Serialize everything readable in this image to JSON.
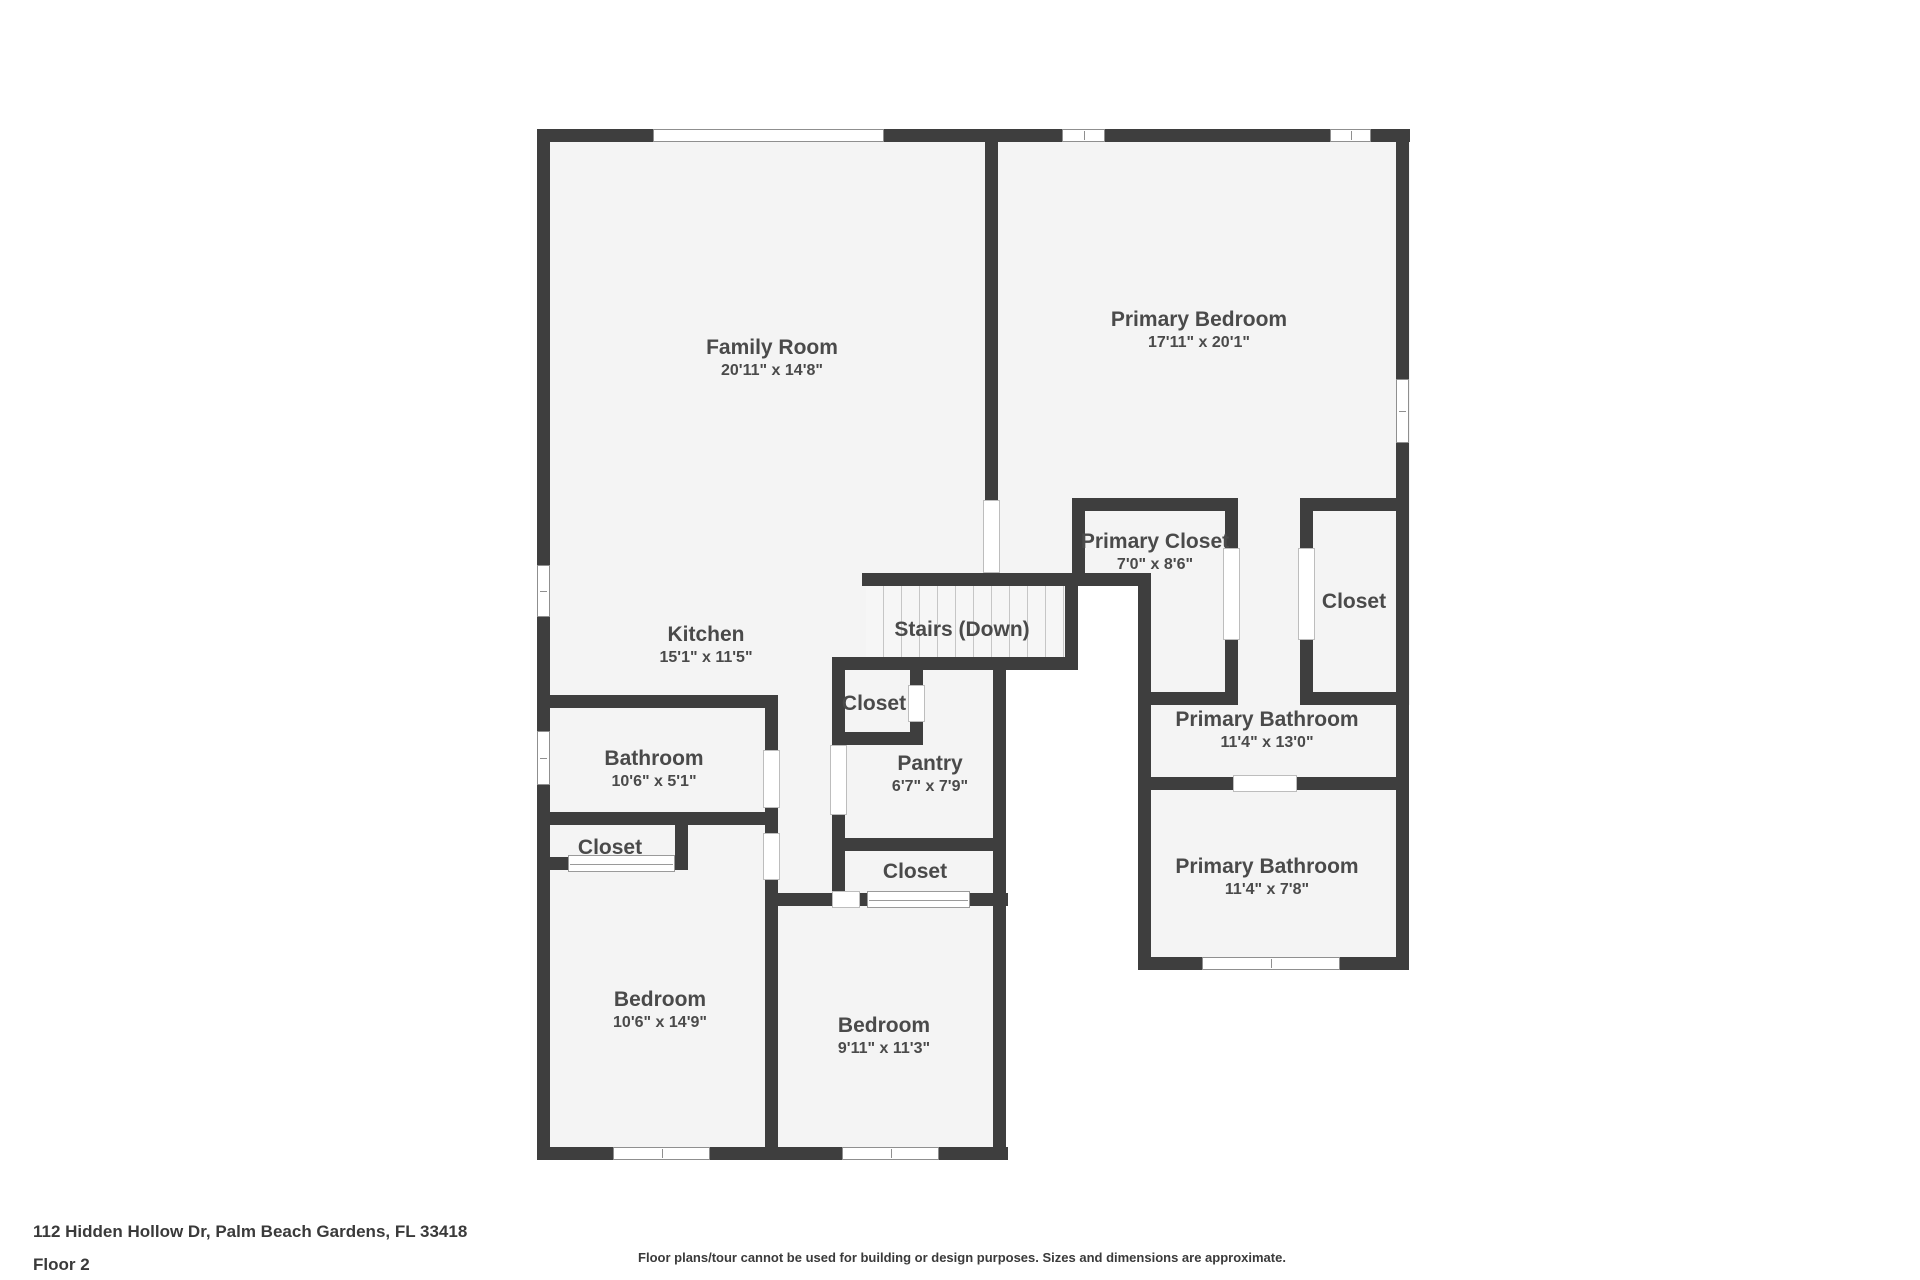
{
  "colors": {
    "wall": "#3e3e3e",
    "floor": "#f4f4f4",
    "label": "#4a4a4a",
    "background": "#ffffff"
  },
  "rooms": [
    {
      "id": "family-room",
      "name": "Family Room",
      "dims": "20'11\" x 14'8\""
    },
    {
      "id": "primary-bedroom",
      "name": "Primary Bedroom",
      "dims": "17'11\" x 20'1\""
    },
    {
      "id": "kitchen",
      "name": "Kitchen",
      "dims": "15'1\" x 11'5\""
    },
    {
      "id": "stairs-down",
      "name": "Stairs (Down)",
      "dims": ""
    },
    {
      "id": "primary-closet",
      "name": "Primary Closet",
      "dims": "7'0\" x 8'6\""
    },
    {
      "id": "closet-right",
      "name": "Closet",
      "dims": ""
    },
    {
      "id": "closet-hall",
      "name": "Closet",
      "dims": ""
    },
    {
      "id": "pantry",
      "name": "Pantry",
      "dims": "6'7\" x 7'9\""
    },
    {
      "id": "bathroom",
      "name": "Bathroom",
      "dims": "10'6\" x 5'1\""
    },
    {
      "id": "closet-bedroom-left",
      "name": "Closet",
      "dims": ""
    },
    {
      "id": "closet-bedroom-mid",
      "name": "Closet",
      "dims": ""
    },
    {
      "id": "primary-bathroom-upper",
      "name": "Primary Bathroom",
      "dims": "11'4\" x 13'0\""
    },
    {
      "id": "primary-bathroom-lower",
      "name": "Primary Bathroom",
      "dims": "11'4\" x 7'8\""
    },
    {
      "id": "bedroom-left",
      "name": "Bedroom",
      "dims": "10'6\" x 14'9\""
    },
    {
      "id": "bedroom-mid",
      "name": "Bedroom",
      "dims": "9'11\" x 11'3\""
    }
  ],
  "footer": {
    "address": "112 Hidden Hollow Dr, Palm Beach Gardens, FL 33418",
    "floor_label": "Floor 2",
    "disclaimer": "Floor plans/tour cannot be used for building or design purposes. Sizes and dimensions are approximate."
  }
}
